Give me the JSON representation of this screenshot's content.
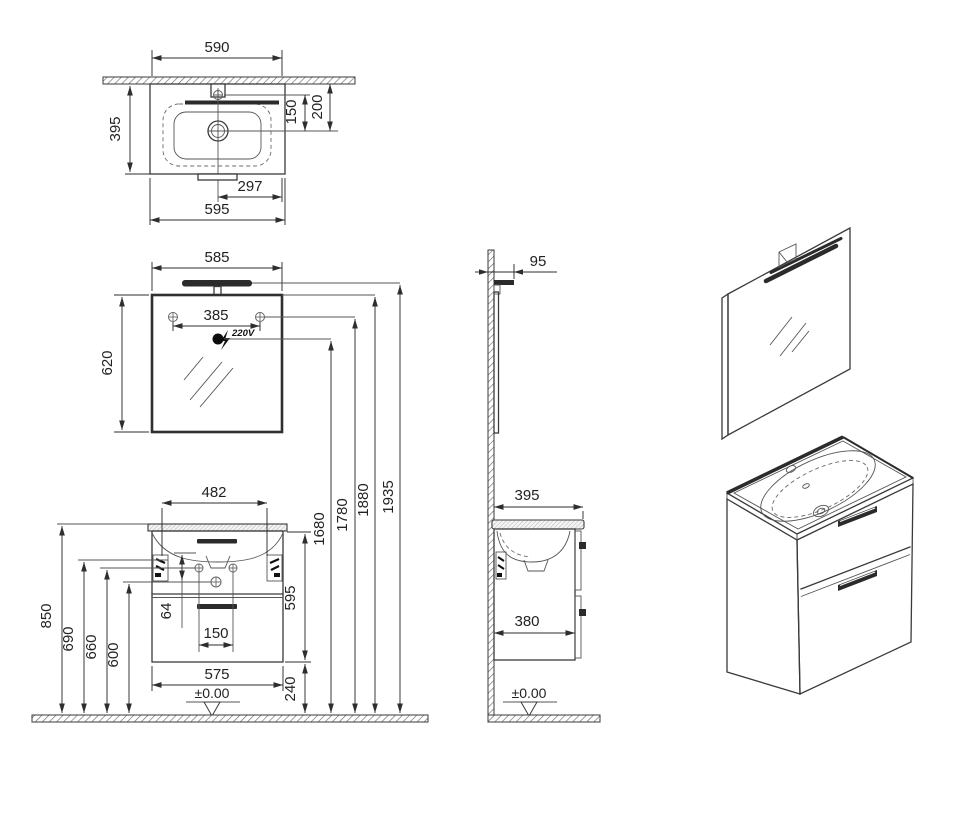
{
  "drawing_colors": {
    "line": "#3a3a3a",
    "fill": "#ffffff",
    "accent_dark": "#2b2b2b"
  },
  "views": {
    "basin_top": {
      "dim_width_top": "590",
      "dim_depth": "395",
      "dim_tap_to_drain": "150",
      "dim_wall_to_drain": "200",
      "dim_center_to_right": "297",
      "dim_width_total": "595"
    },
    "mirror_front": {
      "dim_width": "585",
      "dim_screw_span": "385",
      "dim_height": "620",
      "outlet_label": "220V"
    },
    "installation_heights": {
      "dim_outlet": "1680",
      "dim_screws": "1780",
      "dim_mirror_top": "1880",
      "dim_light_top": "1935"
    },
    "cabinet_front": {
      "dim_bracket_span": "482",
      "dim_counter_height": "850",
      "dim_bracket_height": "690",
      "dim_holes_height": "660",
      "dim_drain_height": "600",
      "dim_hole_offset": "64",
      "dim_drain_span": "150",
      "dim_body_height": "595",
      "dim_bottom_clearance": "240",
      "dim_body_width": "575",
      "floor_level": "±0.00"
    },
    "cabinet_side": {
      "dim_light_depth": "95",
      "dim_counter_depth": "395",
      "dim_body_depth": "380",
      "floor_level": "±0.00"
    }
  }
}
